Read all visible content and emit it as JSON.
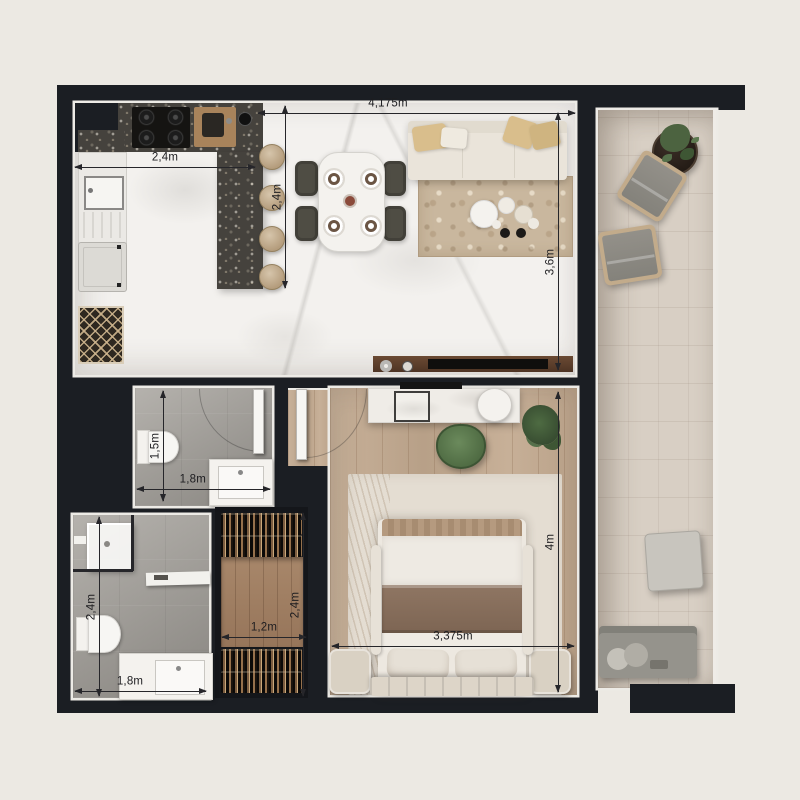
{
  "floorplan": {
    "dimensions": {
      "kitchen_width": "2,4m",
      "kitchen_depth": "2,4m",
      "living_width": "4,175m",
      "living_depth": "3,6m",
      "bathroom_top_depth": "1,5m",
      "bathroom_top_width": "1,8m",
      "bathroom_bottom_depth": "2,4m",
      "bathroom_bottom_width": "1,8m",
      "closet_width": "1,2m",
      "closet_depth": "2,4m",
      "bedroom_width": "3,375m",
      "bedroom_depth": "4m"
    },
    "colors": {
      "page_background": "#ECE9E3",
      "walls": "#1B1E23",
      "marble_floor": "#F3F1EE",
      "counter_terrazzo": "#45423D",
      "wood_floor": "#C3AA90",
      "balcony_tile": "#D8CFC4",
      "bathroom_concrete": "#A5A29D",
      "rug_living": "#C9B79E",
      "rug_bedroom": "#E4DDD2",
      "dimension_line": "#26262A"
    }
  }
}
